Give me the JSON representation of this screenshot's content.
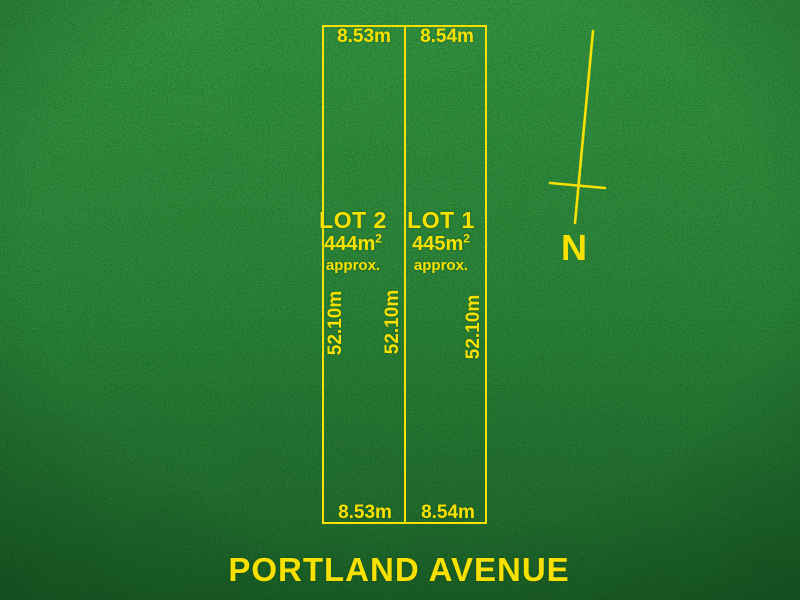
{
  "plan": {
    "street_label": "PORTLAND AVENUE",
    "compass": {
      "label": "N"
    },
    "lot2": {
      "name": "LOT 2",
      "area_value": "444m",
      "area_exponent": "2",
      "area_qualifier": "approx.",
      "width_top": "8.53m",
      "width_bottom": "8.53m",
      "depth": "52.10m"
    },
    "lot1": {
      "name": "LOT 1",
      "area_value": "445m",
      "area_exponent": "2",
      "area_qualifier": "approx.",
      "width_top": "8.54m",
      "width_bottom": "8.54m",
      "depth": "52.10m"
    },
    "shared_boundary_depth": "52.10m"
  },
  "colors": {
    "accent_yellow": "#f8e100",
    "grass_green_light": "#3a9c47",
    "grass_green_mid": "#2f8a3d",
    "grass_green_dark": "#1f652c"
  }
}
